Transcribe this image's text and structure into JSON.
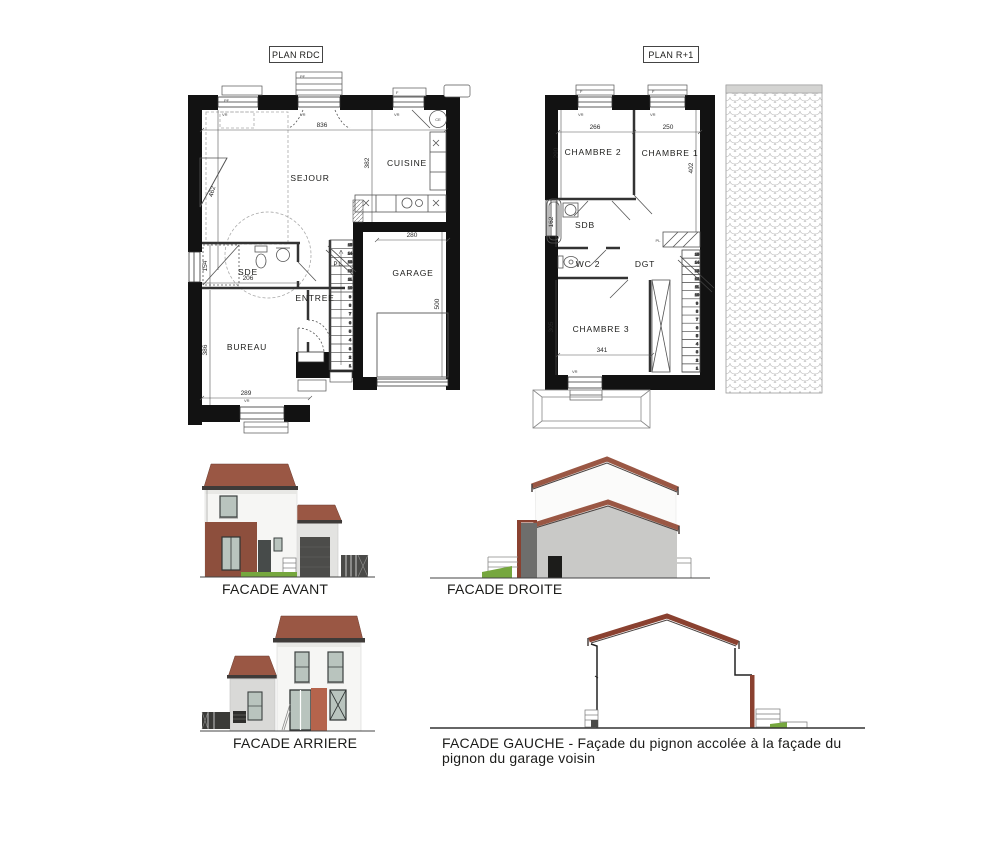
{
  "plan_rdc": {
    "title": "PLAN RDC",
    "rooms": {
      "sejour": "SEJOUR",
      "cuisine": "CUISINE",
      "sde": "SDE",
      "entree": "ENTREE",
      "bureau": "BUREAU",
      "garage": "GARAGE",
      "placard": "PL"
    },
    "dims": {
      "width_top": "836",
      "cuisine_depth": "382",
      "sejour_left": "462",
      "sde_height": "154",
      "sde_width": "206",
      "bureau_height": "386",
      "bureau_width": "289",
      "garage_width": "280",
      "garage_depth": "500"
    }
  },
  "plan_r1": {
    "title": "PLAN R+1",
    "rooms": {
      "chambre2": "CHAMBRE 2",
      "chambre1": "CHAMBRE 1",
      "sdb": "SDB",
      "wc2": "WC 2",
      "dgt": "DGT",
      "chambre3": "CHAMBRE 3",
      "placard": "PL"
    },
    "dims": {
      "chambre2_width": "266",
      "chambre1_width": "250",
      "chambre2_depth": "290",
      "chambre1_depth": "402",
      "sdb_height": "162",
      "chambre3_depth": "305",
      "chambre3_width": "341"
    }
  },
  "annotations": {
    "vr": "VR",
    "pf": "PF",
    "f": "F",
    "ce": "CE"
  },
  "stairs": {
    "steps": 15
  },
  "facades": {
    "avant": {
      "label": "FACADE AVANT"
    },
    "droite": {
      "label": "FACADE DROITE"
    },
    "arriere": {
      "label": "FACADE ARRIERE"
    },
    "gauche": {
      "label": "FACADE GAUCHE - Façade du pignon accolée à la façade du pignon du garage voisin"
    }
  },
  "colors": {
    "roof_red": "#9a5744",
    "brick": "#8d4f3d",
    "rear_panel": "#b5644c",
    "wall_white": "#f6f6f4",
    "wall_gray": "#c9c9c7",
    "garage_gray": "#e3e3e1",
    "door_dark": "#474b4a",
    "glass": "#b9c4be",
    "grass": "#76a73e",
    "roof_edge": "#8a4130"
  }
}
